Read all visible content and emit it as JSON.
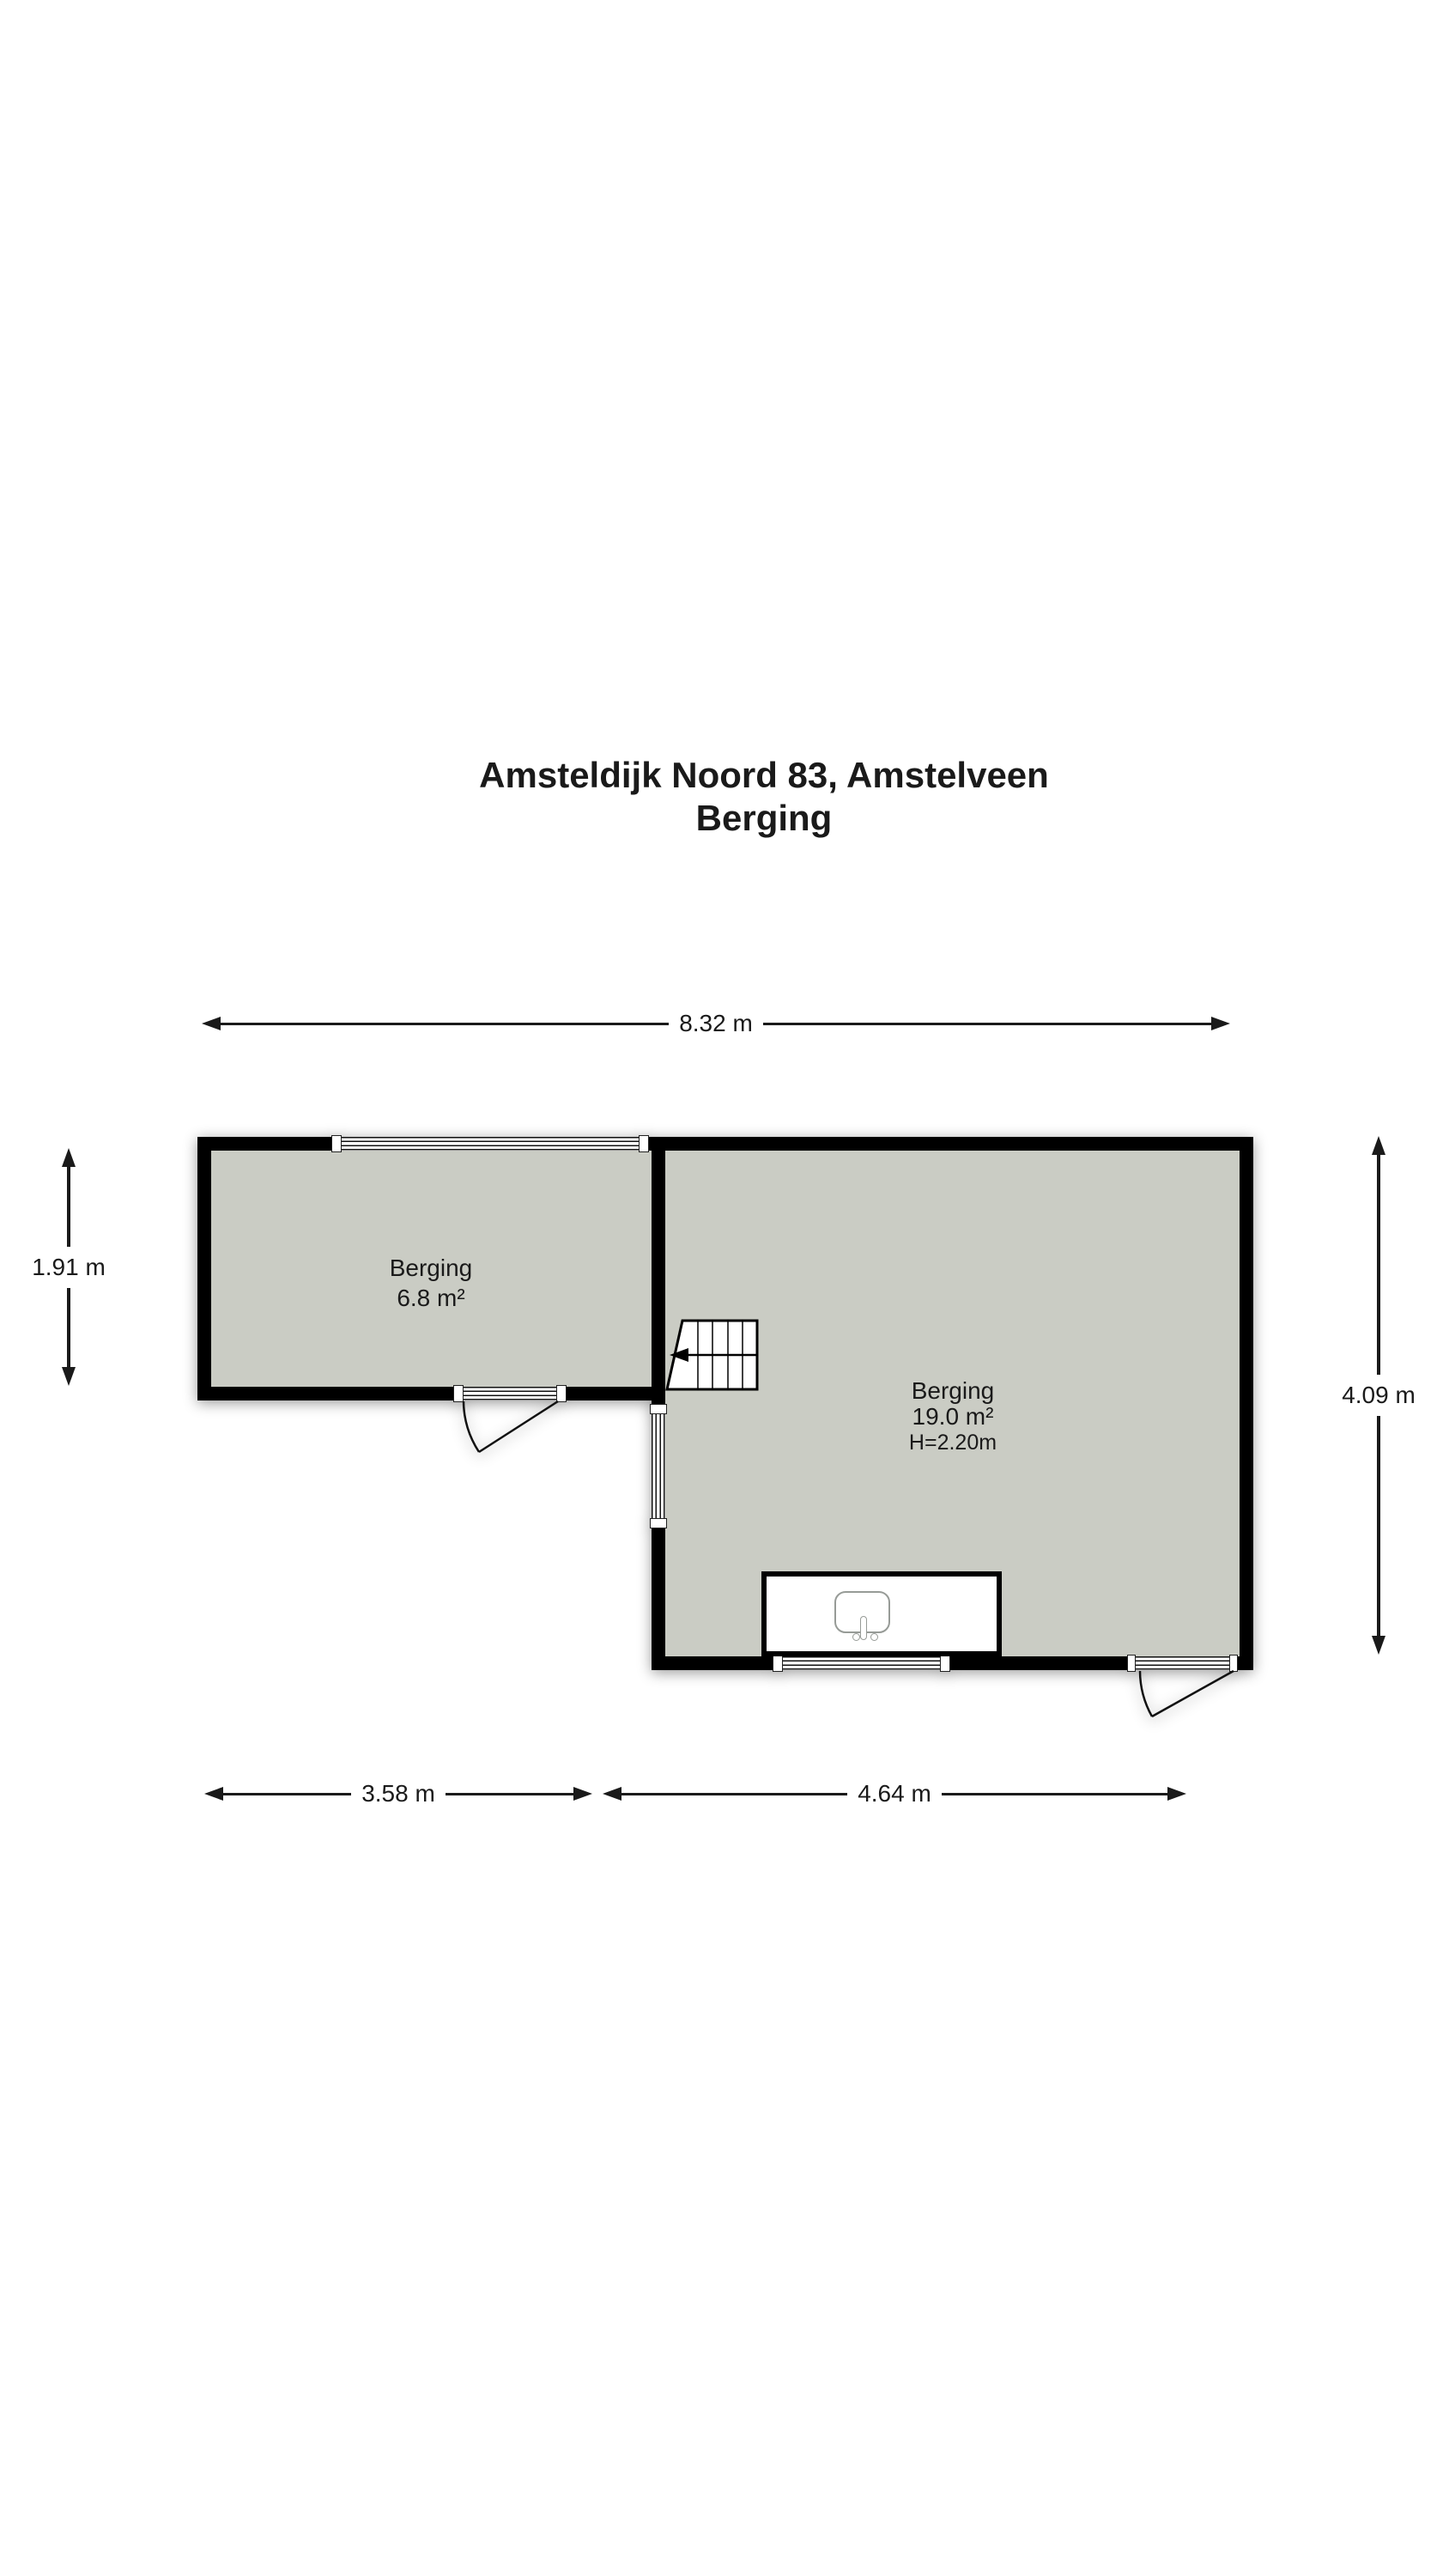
{
  "title": {
    "line1": "Amsteldijk Noord 83, Amstelveen",
    "line2": "Berging"
  },
  "dimensions": {
    "top": "8.32 m",
    "left": "1.91 m",
    "right": "4.09 m",
    "bottom_left": "3.58 m",
    "bottom_right": "4.64 m"
  },
  "rooms": {
    "small": {
      "name": "Berging",
      "area": "6.8 m²"
    },
    "large": {
      "name": "Berging",
      "area": "19.0 m²",
      "ceiling": "H=2.20m"
    }
  },
  "colors": {
    "wall": "#000000",
    "room_fill": "#caccc4",
    "background": "#ffffff",
    "text": "#1a1a1a"
  }
}
